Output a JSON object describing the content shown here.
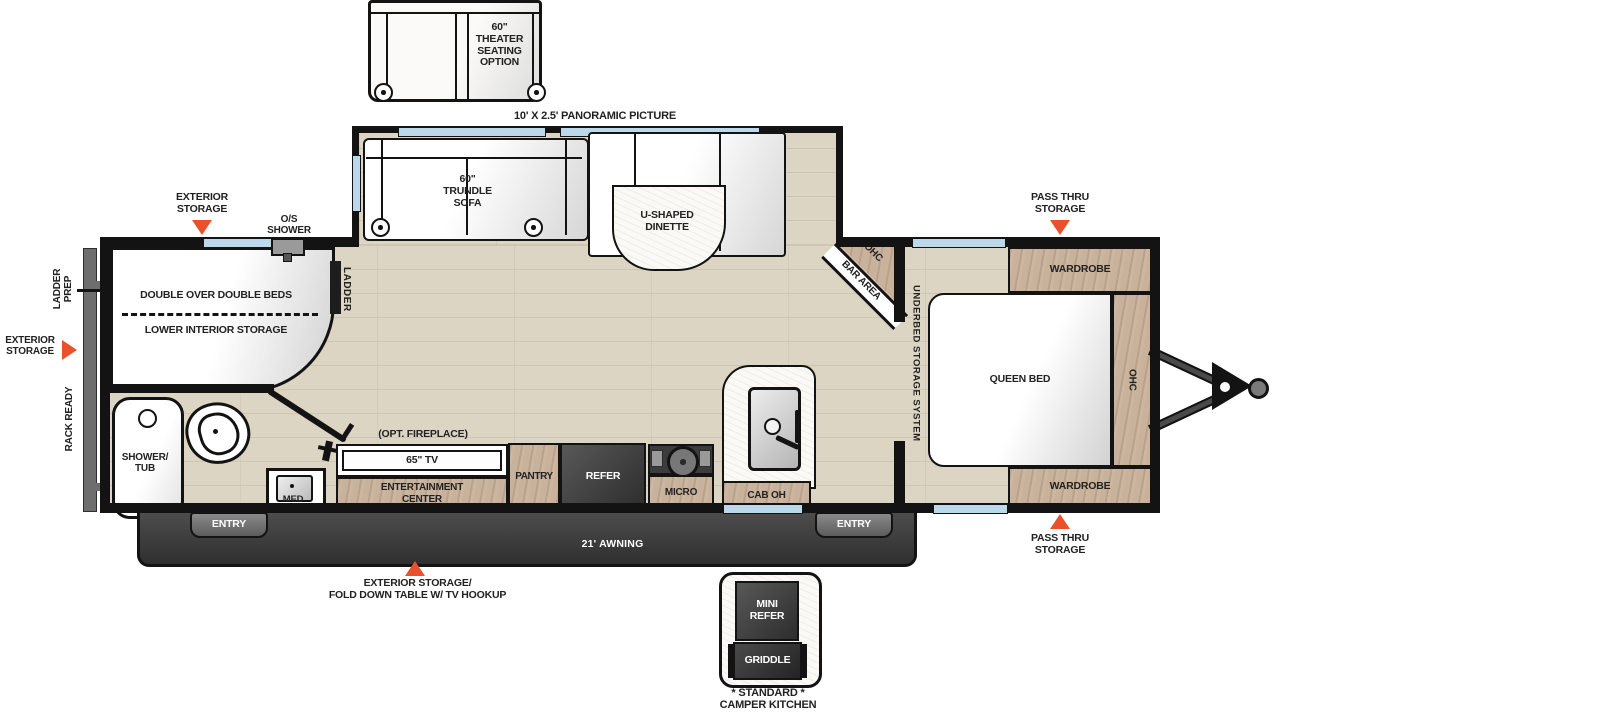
{
  "plan": {
    "theater_option": "60\"\nTHEATER\nSEATING\nOPTION",
    "panoramic_window": "10' X 2.5' PANORAMIC PICTURE",
    "trundle_sofa": "60\"\nTRUNDLE\nSOFA",
    "dinette": "U-SHAPED\nDINETTE",
    "bar_ohc": "OHC",
    "bar_area": "BAR AREA",
    "underbed": "UNDERBED STORAGE SYSTEM",
    "queen_bed": "QUEEN BED",
    "wardrobe": "WARDROBE",
    "ohc": "OHC",
    "pass_thru": "PASS THRU\nSTORAGE",
    "beds": "DOUBLE OVER DOUBLE BEDS",
    "lower_storage": "LOWER INTERIOR STORAGE",
    "ladder": "LADDER",
    "ladder_prep": "LADDER\nPREP",
    "rack_ready": "RACK READY",
    "os_shower": "O/S\nSHOWER",
    "ext_storage": "EXTERIOR\nSTORAGE",
    "shower_tub": "SHOWER/\nTUB",
    "med": "MED",
    "entry": "ENTRY",
    "opt_fireplace": "(OPT. FIREPLACE)",
    "tv": "65\" TV",
    "ent_center": "ENTERTAINMENT\nCENTER",
    "pantry": "PANTRY",
    "refer": "REFER",
    "micro": "MICRO",
    "cab_oh": "CAB OH",
    "awning": "21' AWNING",
    "ext_storage_table": "EXTERIOR STORAGE/\nFOLD DOWN TABLE W/ TV HOOKUP",
    "mini_refer": "MINI\nREFER",
    "griddle": "GRIDDLE",
    "camper_kitchen": "* STANDARD *\nCAMPER KITCHEN"
  },
  "colors": {
    "accent": "#e8512b",
    "wall": "#131313",
    "cabinet_wood": "#c9b29b",
    "floor": "#ddd5c4",
    "window": "#bcd9ec",
    "appliance_dark": "#3f3f3f"
  }
}
